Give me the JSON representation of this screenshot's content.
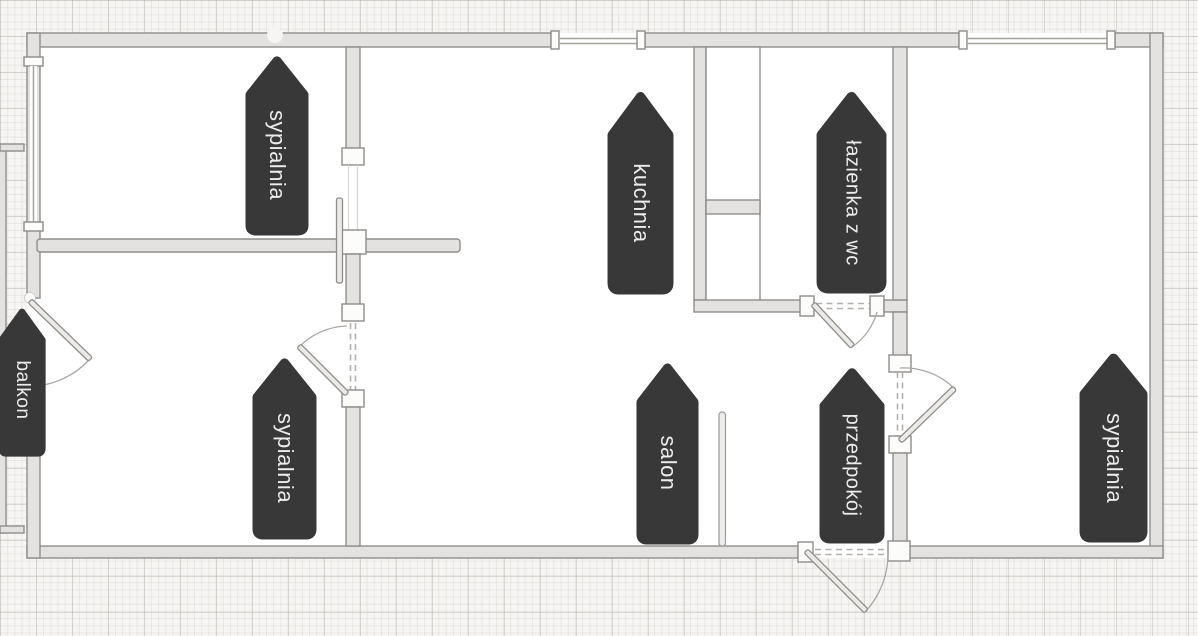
{
  "plan": {
    "rooms": [
      {
        "id": "sypialnia-top-left",
        "label": "sypialnia"
      },
      {
        "id": "kuchnia",
        "label": "kuchnia"
      },
      {
        "id": "lazienka-z-wc",
        "label": "łazienka z wc"
      },
      {
        "id": "balkon",
        "label": "balkon"
      },
      {
        "id": "sypialnia-bottom-left",
        "label": "sypialnia"
      },
      {
        "id": "salon",
        "label": "salon"
      },
      {
        "id": "przedpokoj",
        "label": "przedpokój"
      },
      {
        "id": "sypialnia-right",
        "label": "sypialnia"
      }
    ],
    "colors": {
      "label_bg": "#383838",
      "label_text": "#ececec",
      "wall_fill": "#e4e2e0",
      "wall_stroke": "#908e8b",
      "background": "#f6f5f3",
      "room_fill": "#ffffff"
    }
  }
}
